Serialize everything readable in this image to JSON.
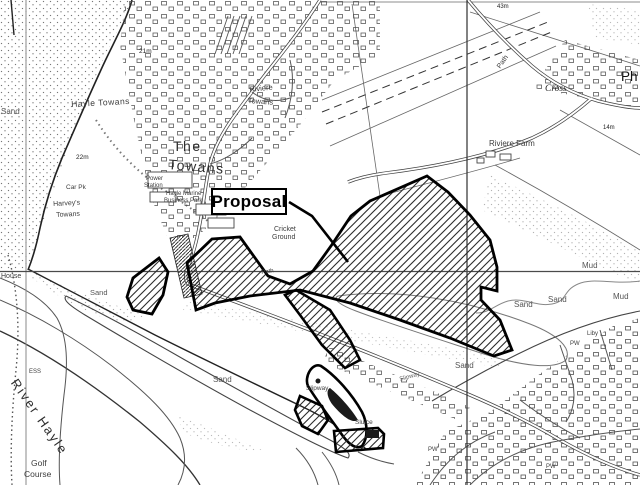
{
  "map": {
    "proposal_label": "Proposal",
    "labels": {
      "sand_nw": "Sand",
      "hayle_towans": "Hayle Towans",
      "elev_22m": "22m",
      "elev_21m": "21m",
      "the": "The",
      "towans": "Towans",
      "riviere": "Riviere",
      "riviere_towans": "Towans",
      "power": "Power",
      "station": "Station",
      "hayle_marine": "Hayle Marine",
      "business_park": "Business Park",
      "car_pk": "Car Pk",
      "harveys": "Harvey's",
      "harveys_towans": "Towans",
      "cricket": "Cricket",
      "ground": "Ground",
      "path_mid": "Path",
      "elev_43m": "43m",
      "path_ne": "Path",
      "cross": "Cross",
      "ph": "Ph",
      "riviere_farm": "Riviere Farm",
      "elev_14m": "14m",
      "house": "House",
      "sand_w": "Sand",
      "sand_estuary": "Sand",
      "river_hayle": "River Hayle",
      "ess": "ESS",
      "golf": "Golf",
      "course": "Course",
      "slipway_w": "Slipway",
      "slipway_e": "Slipway",
      "sluice": "Sluice",
      "sand_mid": "Sand",
      "sand_e1": "Sand",
      "sand_e2": "Sand",
      "mud_n": "Mud",
      "mud_e": "Mud",
      "pw_1": "PW",
      "liby": "Liby",
      "pw_2": "PW",
      "pw_3": "PW"
    },
    "colors": {
      "background": "#ffffff",
      "map_line": "#3a3a3a",
      "grid_line": "#4d4d4d",
      "proposal_outline": "#000000",
      "label_color": "#3d3d3d"
    }
  }
}
